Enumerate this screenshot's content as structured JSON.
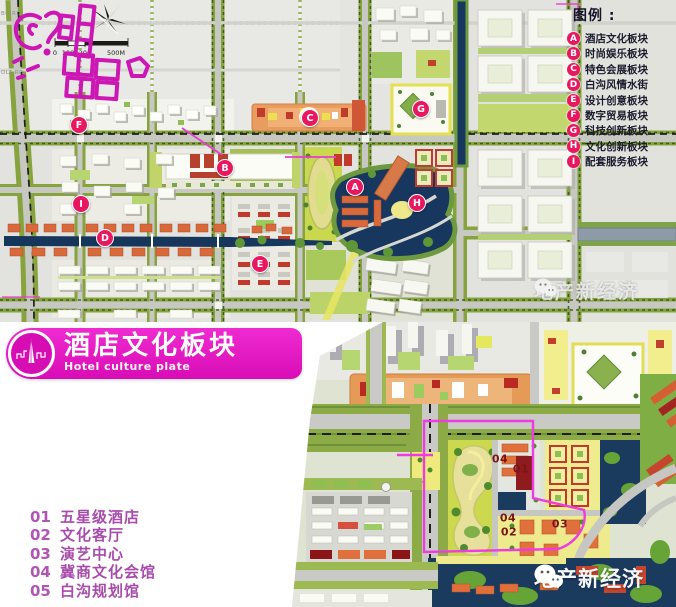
{
  "legend": {
    "title": "图例 :",
    "items": [
      {
        "letter": "A",
        "label": "酒店文化板块"
      },
      {
        "letter": "B",
        "label": "时尚娱乐板块"
      },
      {
        "letter": "C",
        "label": "特色会展板块"
      },
      {
        "letter": "D",
        "label": "白沟风情水街"
      },
      {
        "letter": "E",
        "label": "设计创意板块"
      },
      {
        "letter": "F",
        "label": "数字贸易板块"
      },
      {
        "letter": "G",
        "label": "科技创新板块"
      },
      {
        "letter": "H",
        "label": "文化创新板块"
      },
      {
        "letter": "I",
        "label": "配套服务板块"
      }
    ]
  },
  "markers": [
    {
      "letter": "F",
      "x": 78,
      "y": 124
    },
    {
      "letter": "C",
      "x": 309,
      "y": 117
    },
    {
      "letter": "B",
      "x": 224,
      "y": 167
    },
    {
      "letter": "I",
      "x": 80,
      "y": 203
    },
    {
      "letter": "D",
      "x": 104,
      "y": 237
    },
    {
      "letter": "E",
      "x": 259,
      "y": 263
    },
    {
      "letter": "G",
      "x": 420,
      "y": 108
    },
    {
      "letter": "A",
      "x": 354,
      "y": 186
    },
    {
      "letter": "H",
      "x": 416,
      "y": 202
    }
  ],
  "scalebar": {
    "labels": [
      {
        "text": "0",
        "x": 55
      },
      {
        "text": "100",
        "x": 68
      },
      {
        "text": "200",
        "x": 85
      },
      {
        "text": "500M",
        "x": 116
      }
    ]
  },
  "road_labels": [
    {
      "text": "BU RD",
      "x": 1,
      "y": 11
    },
    {
      "text": "OLT RD",
      "x": 1,
      "y": 70
    }
  ],
  "watermark": {
    "text": "地产新经济"
  },
  "plate": {
    "title": "酒店文化板块",
    "subtitle": "Hotel culture plate"
  },
  "list": {
    "items": [
      {
        "num": "01",
        "label": "五星级酒店"
      },
      {
        "num": "02",
        "label": "文化客厅"
      },
      {
        "num": "03",
        "label": "演艺中心"
      },
      {
        "num": "04",
        "label": "冀商文化会馆"
      },
      {
        "num": "05",
        "label": "白沟规划馆"
      }
    ]
  },
  "detail_labels": [
    {
      "text": "04",
      "x": 500,
      "y": 459
    },
    {
      "text": "01",
      "x": 521,
      "y": 469
    },
    {
      "text": "04",
      "x": 508,
      "y": 518
    },
    {
      "text": "02",
      "x": 509,
      "y": 532
    },
    {
      "text": "03",
      "x": 560,
      "y": 524
    }
  ]
}
